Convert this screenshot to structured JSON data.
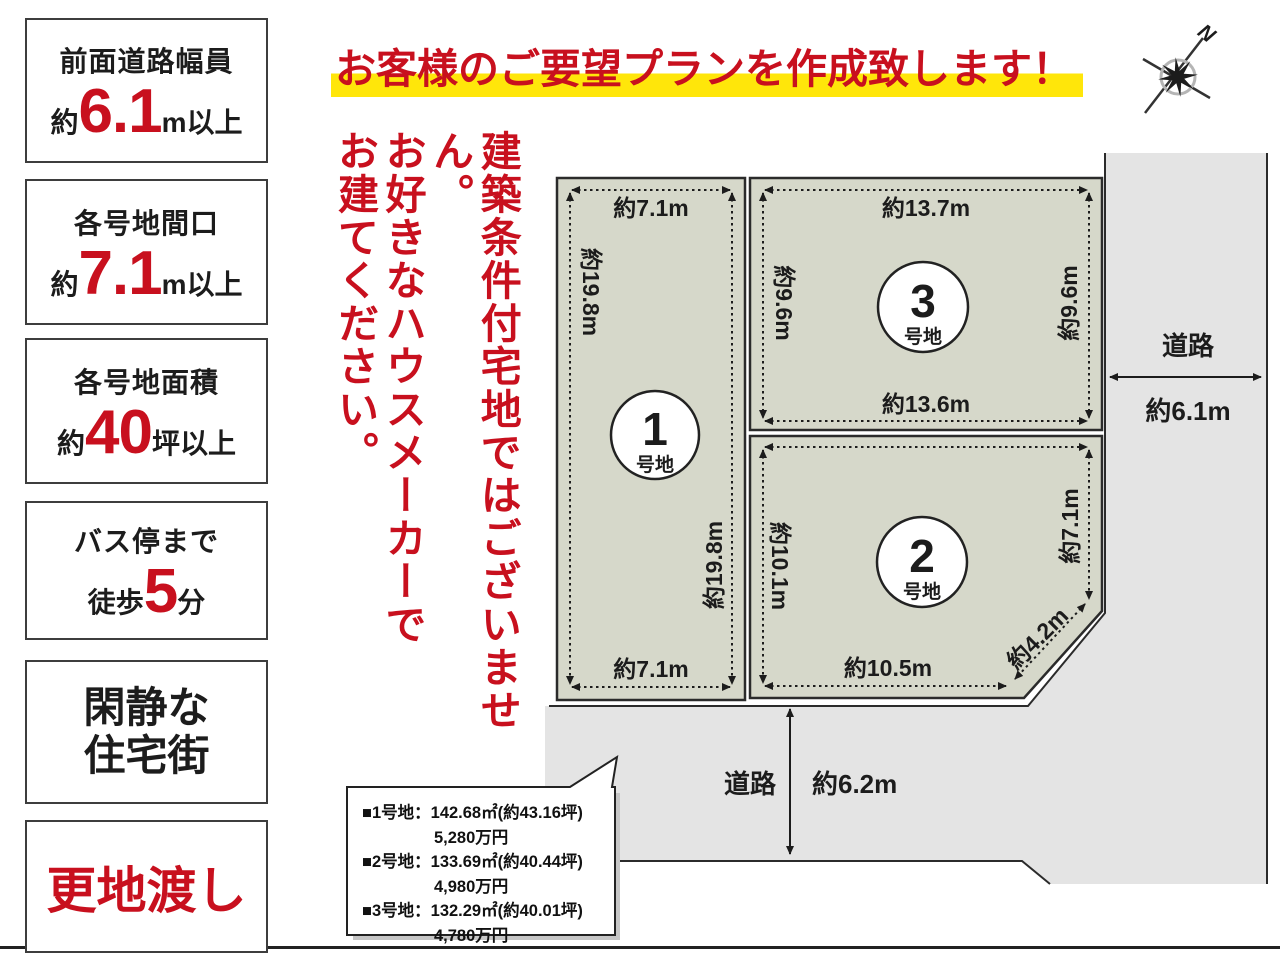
{
  "banner": {
    "text": "お客様のご要望プランを作成致します！"
  },
  "notice": {
    "line1": "建築条件付宅地ではございません。",
    "line2": "お好きなハウスメーカーで",
    "line3": "お建てください。"
  },
  "features": {
    "box1": {
      "title": "前面道路幅員",
      "prefix": "約",
      "big": "6.1",
      "suffix": "m以上"
    },
    "box2": {
      "title": "各号地間口",
      "prefix": "約",
      "big": "7.1",
      "suffix": "m以上"
    },
    "box3": {
      "title": "各号地面積",
      "prefix": "約",
      "big": "40",
      "suffix": "坪以上"
    },
    "box4": {
      "title": "バス停まで",
      "prefix": "徒歩",
      "big": "5",
      "suffix": "分"
    },
    "box5": {
      "line1": "閑静な",
      "line2": "住宅街"
    },
    "box6": {
      "text": "更地渡し"
    }
  },
  "compass": {
    "label": "N"
  },
  "diagram": {
    "plots": [
      {
        "number": "1",
        "label": "号地",
        "dims": {
          "top": "約7.1m",
          "left": "約19.8m",
          "right": "約19.8m",
          "bottom": "約7.1m"
        }
      },
      {
        "number": "2",
        "label": "号地",
        "dims": {
          "left": "約10.1m",
          "right": "約7.1m",
          "diagonal": "約4.2m",
          "bottom": "約10.5m"
        }
      },
      {
        "number": "3",
        "label": "号地",
        "dims": {
          "top": "約13.7m",
          "left": "約9.6m",
          "right": "約9.6m",
          "bottom": "約13.6m"
        }
      }
    ],
    "roads": {
      "right": {
        "label": "道路",
        "width": "約6.1m"
      },
      "bottom": {
        "label": "道路",
        "width": "約6.2m"
      }
    }
  },
  "info_box": {
    "lines": [
      "■1号地：142.68㎡(約43.16坪)",
      "5,280万円",
      "■2号地：133.69㎡(約40.44坪)",
      "4,980万円",
      "■3号地：132.29㎡(約40.01坪)",
      "4,780万円"
    ]
  },
  "colors": {
    "red": "#c8101e",
    "yellow": "#ffe60a",
    "plot": "#d6d8ca",
    "road": "#e4e4e4",
    "ink": "#1c1c1c"
  }
}
